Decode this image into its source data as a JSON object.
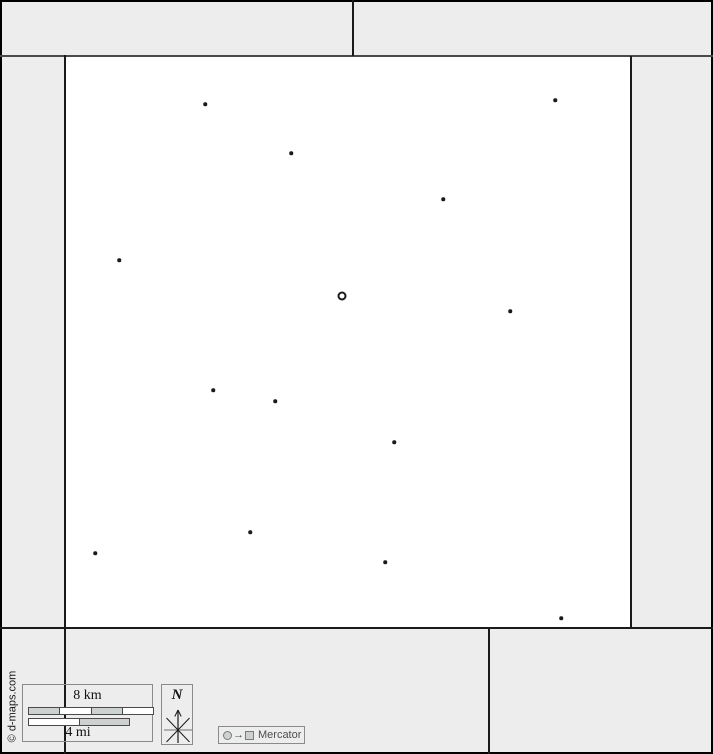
{
  "colors": {
    "background": "#ededed",
    "map_fill": "#ffffff",
    "line": "#1a1a1a",
    "band_line": "#4a4a4a",
    "box_border": "#8a8a8a",
    "bar_fill": "#ccd2d2",
    "muted_text": "#4d4d4d"
  },
  "attribution": {
    "text": "© d-maps.com"
  },
  "scale_bar": {
    "km_label": "8 km",
    "mi_label": "4 mi"
  },
  "compass": {
    "north_label": "N"
  },
  "projection": {
    "label": "Mercator",
    "arrow_symbol": "→"
  },
  "map_data": {
    "capital_marker": {
      "x": 342,
      "y": 296
    },
    "city_dots": [
      [
        205,
        104
      ],
      [
        555,
        100
      ],
      [
        291,
        153
      ],
      [
        443,
        199
      ],
      [
        119,
        260
      ],
      [
        510,
        311
      ],
      [
        213,
        390
      ],
      [
        275,
        401
      ],
      [
        394,
        442
      ],
      [
        250,
        532
      ],
      [
        95,
        553
      ],
      [
        385,
        562
      ],
      [
        561,
        618
      ]
    ]
  }
}
